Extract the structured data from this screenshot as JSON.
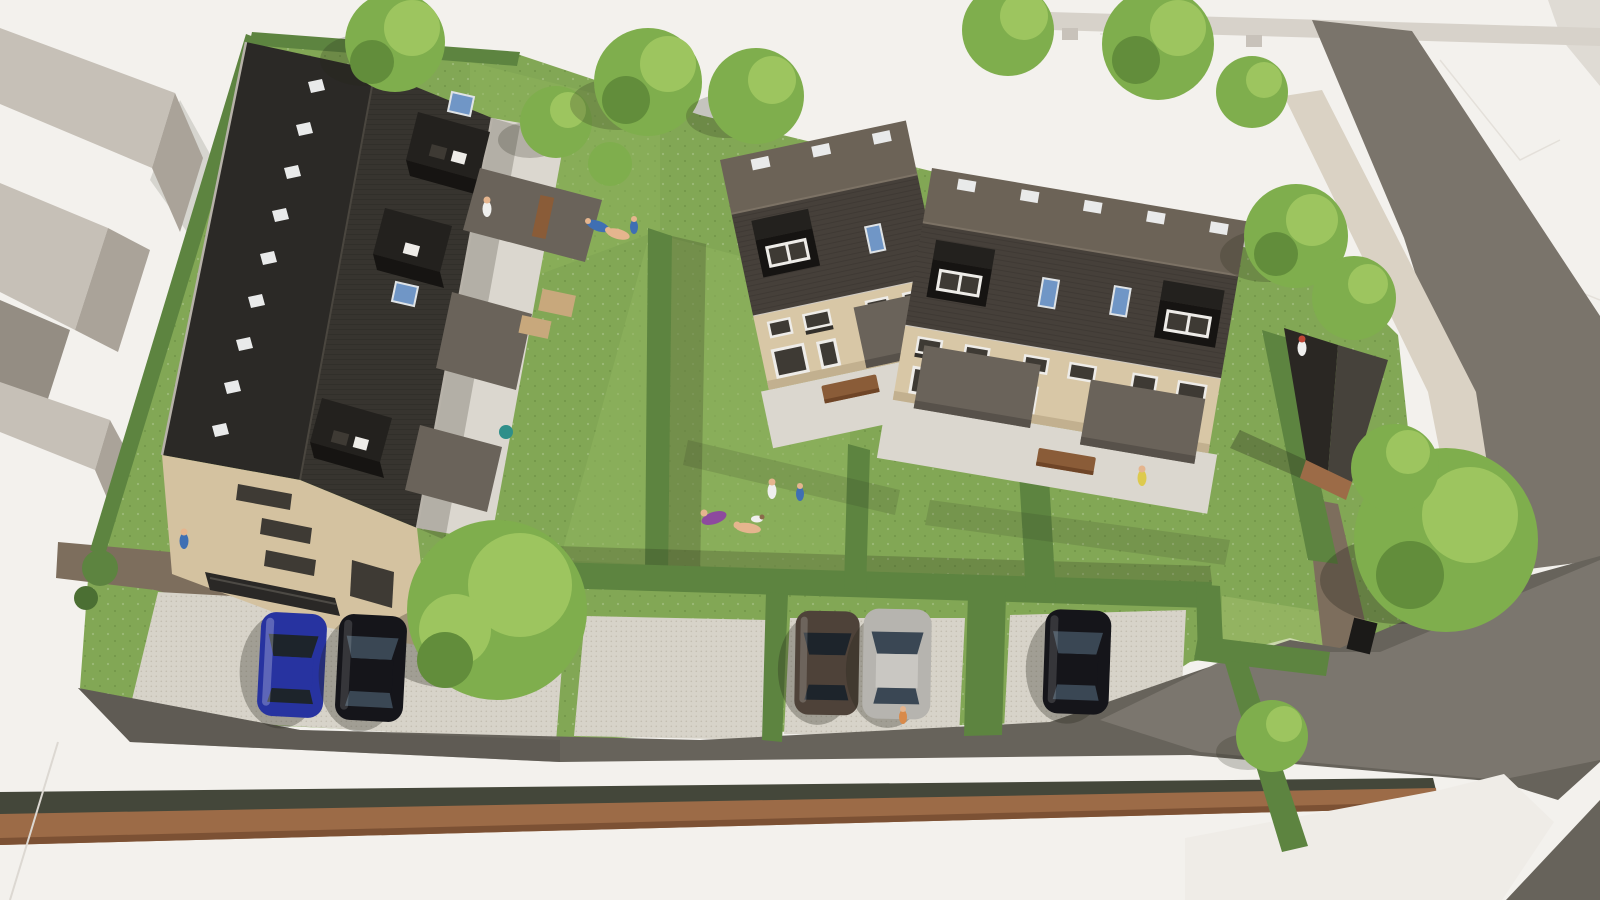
{
  "meta": {
    "type": "3d-architectural-aerial-render",
    "description": "Aerial 3D visualisation of a residential infill development: a long apartment building with dark pitched roof on the west, two beige terraced house blocks with dark mansard roofs in the centre, a garden shed on the east, communal lawns divided by hedges, paved parking bays with five cars, and an asphalt access road with a brick retaining wall along the south edge. Surrounding context is shown as untextured white/grey massing.",
    "width_px": 1600,
    "height_px": 900
  },
  "palette": {
    "bg": "#f3f1ed",
    "ctxLight": "#c6c0b7",
    "ctxMid": "#aaa399",
    "ctxDark": "#948d83",
    "barGray": "#d7d2ca",
    "tabGray": "#c8c2ba",
    "cornerGray": "#dfdbd4",
    "whiteShape": "#efece7",
    "roadNE": "#7a746b",
    "roadSite": "#67635b",
    "roadLit": "#7d7870",
    "roadDark": "#5a564f",
    "sidewalk": "#dad2c4",
    "pathBrown": "#7d6e5d",
    "woodWall": "#9c6b47",
    "woodDark": "#7c5134",
    "verge": "#44473a",
    "lawn": "#82a755",
    "lawnLight": "#90b55e",
    "lawnPale": "#a4bf6e",
    "hedge": "#5d8440",
    "hedgeDark": "#4b6f33",
    "treeBright": "#9dc55f",
    "treeMid": "#7fae4d",
    "treeDark": "#628d3b",
    "pad": "#d7d3c9",
    "padDot": "#c3beb1",
    "patio": "#dbd7cf",
    "roofBlackL": "#2b2926",
    "roofBlackR": "#37342f",
    "eave": "#b7b2a9",
    "roofUpper": "#6c6357",
    "roofSteep": "#46403a",
    "dormerTop": "#23211e",
    "dormerFace": "#161412",
    "wallBeige": "#d8c7a6",
    "wallShade": "#c2b08f",
    "gableBeige": "#d4c2a0",
    "winFrame": "#eeece8",
    "winGlass": "#3e3a34",
    "glassBlue": "#a8b6c2",
    "skyWhite": "#e9eaea",
    "skyBlue": "#7096c6",
    "awning": "#6a635a",
    "awningDark": "#57514a",
    "bench": "#8a5c38",
    "benchDark": "#6f4527",
    "shedLit": "#46423b",
    "shedDark": "#2a2723",
    "carBlue": "#2733a0",
    "carBlack": "#15151a",
    "carSilver": "#b6b4af",
    "carBrown": "#4e4239",
    "carGlass": "#1d242b",
    "carGlassSilver": "#3a4754",
    "skin": "#e5b58e",
    "pBlue": "#3f6fb3",
    "pPurple": "#8d4a9e",
    "pYellow": "#ddca4e",
    "pWhite": "#efefed",
    "pRed": "#bf4636",
    "pTeal": "#2f8f8a",
    "pOrange": "#d98a4a"
  },
  "scene": {
    "buildings": [
      {
        "id": "apartment-building-west",
        "walls": "beige",
        "roof": "charcoal pitched",
        "skylights_white": 9,
        "skylights_blue": 3,
        "roof_dormers": 3,
        "garden_canopies": 3,
        "external_stair": true
      },
      {
        "id": "terrace-block-1",
        "units": 2,
        "walls": "beige",
        "roof": "dark brown mansard",
        "ridge_skylights": 3,
        "blue_roof_windows": 1,
        "dormers": 1,
        "awnings": 1,
        "bench": true
      },
      {
        "id": "terrace-block-2",
        "units": 3,
        "walls": "beige",
        "roof": "dark brown mansard",
        "ridge_skylights": 5,
        "blue_roof_windows": 2,
        "dormers": 2,
        "awnings": 2,
        "bench": true
      },
      {
        "id": "garden-shed-east",
        "roof": "dark",
        "base": "timber"
      }
    ],
    "context_massing_blocks": 5,
    "cars": [
      {
        "color": "blue",
        "area": "west parking"
      },
      {
        "color": "black",
        "area": "west parking"
      },
      {
        "color": "dark-brown",
        "area": "south parking"
      },
      {
        "color": "silver",
        "area": "south parking"
      },
      {
        "color": "black",
        "area": "south-east parking"
      }
    ],
    "parking_pads": 4,
    "hedges": "site boundary, garden dividers and parking separators",
    "trees": 14,
    "people": 12,
    "dog": 1,
    "roads": [
      "south access road with brick retaining wall",
      "north-east street",
      "south-east exit"
    ],
    "lighting": "daylight, sun from east, shadows cast to the west"
  }
}
